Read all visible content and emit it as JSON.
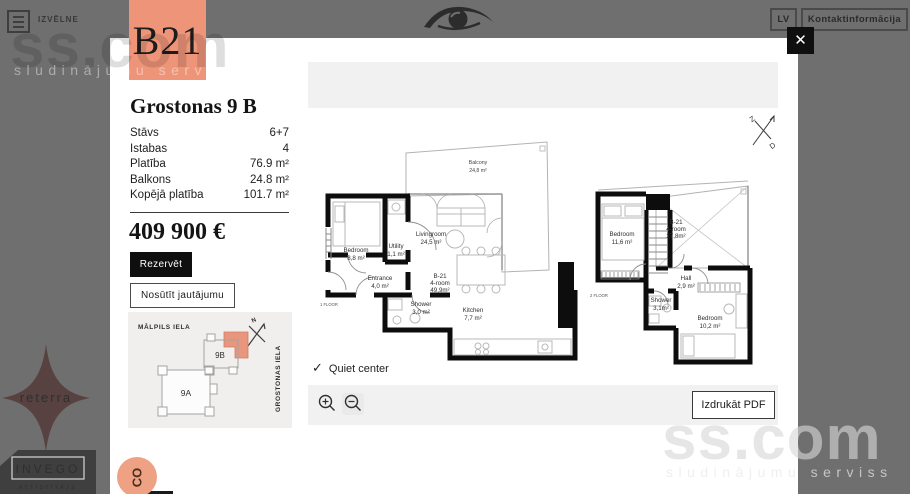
{
  "header": {
    "menu_label": "IZVĒLNE",
    "lang": "LV",
    "contact": "Kontaktinformācija"
  },
  "brand": {
    "logo_text": "B21",
    "watermark": "ss.com",
    "watermark_tagline": "sludinājumu serviss"
  },
  "listing": {
    "title": "Grostonas 9 B",
    "details": [
      {
        "label": "Stāvs",
        "value": "6+7"
      },
      {
        "label": "Istabas",
        "value": "4"
      },
      {
        "label": "Platība",
        "value": "76.9 m²"
      },
      {
        "label": "Balkons",
        "value": "24.8 m²"
      },
      {
        "label": "Kopējā platība",
        "value": "101.7 m²"
      }
    ],
    "price": "409 900 €",
    "reserve_label": "Rezervēt",
    "ask_label": "Nosūtīt jautājumu",
    "feature": "Quiet center",
    "feature_check": "✓",
    "print_label": "Izdrukāt PDF"
  },
  "map": {
    "street_top": "MĀLPILS IELA",
    "street_right": "GROSTONAS IELA",
    "building_a": "9A",
    "building_b": "9B",
    "compass": "N"
  },
  "plans": {
    "compass": {
      "north": "Z",
      "south": "D"
    },
    "floor1": {
      "label": "1 FLOOR",
      "unit": "B-21",
      "type": "4-room",
      "area": "49,9m²",
      "balcony": {
        "name": "Balcony",
        "area": "24,8 m²"
      },
      "livingroom": {
        "name": "Livingroom",
        "area": "24,5 m²"
      },
      "bedroom": {
        "name": "Bedroom",
        "area": "8,8 m²"
      },
      "utility": {
        "name": "Utility",
        "area": "1,1 m²"
      },
      "entrance": {
        "name": "Entrance",
        "area": "4,0 m²"
      },
      "shower": {
        "name": "Shower",
        "area": "3,0 m²"
      },
      "kitchen": {
        "name": "Kitchen",
        "area": "7,7 m²"
      }
    },
    "floor2": {
      "label": "2 FLOOR",
      "unit": "B-21",
      "type": "4-room",
      "area": "27,8m²",
      "bedroom1": {
        "name": "Bedroom",
        "area": "11,6 m²"
      },
      "hall": {
        "name": "Hall",
        "area": "2,9 m²"
      },
      "shower": {
        "name": "Shower",
        "area": "3,1m²"
      },
      "bedroom2": {
        "name": "Bedroom",
        "area": "10,2 m²"
      }
    }
  },
  "developers": {
    "reterra": "reterra",
    "invego": "INVEGO",
    "invego_tagline": "ATTĪSTĪTĀJS",
    "chat_label": "CO"
  },
  "colors": {
    "accent": "#ee9579",
    "background": "#6f6f6f",
    "wall": "#0d0d0d"
  }
}
